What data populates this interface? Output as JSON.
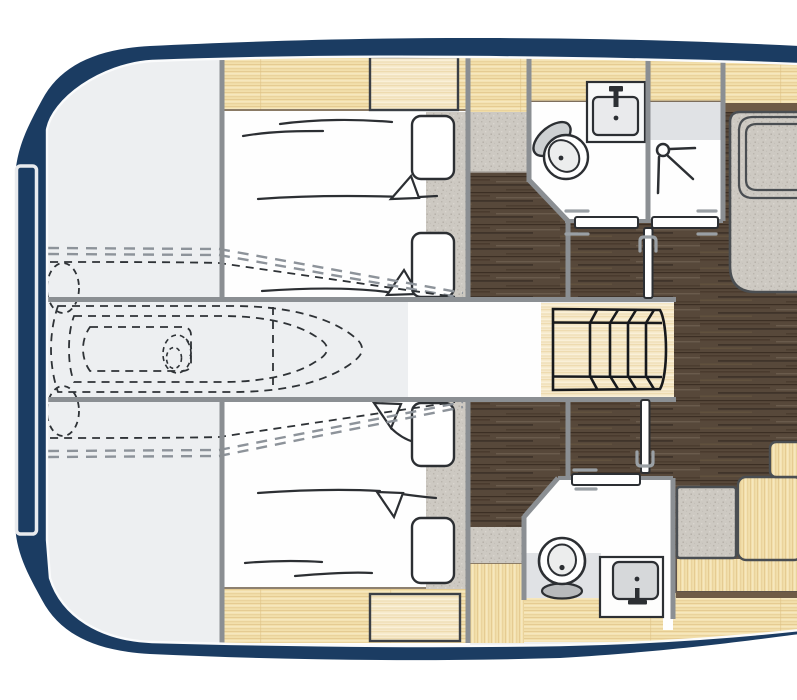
{
  "plan": {
    "type": "yacht-lower-deck-floor-plan",
    "colors": {
      "hull": "#1b3c62",
      "base_floor": "#edeff1",
      "cabin_white": "#fefefe",
      "wall": "#8b8f93",
      "wood_light": "#f2dfab",
      "wood_pale": "#f6e9cb",
      "floor_dark": "#57483a",
      "fabric_base": "#cdc9c2",
      "light_band": "#e0e2e5",
      "trim_brown": "#6f5b46",
      "fixture_line": "#2c2f33",
      "furniture_line": "#4a4e52",
      "door_fill": "#ffffff",
      "handle": "#9aa0a5",
      "dash_dark": "#2e3236",
      "dash_gray": "#8d939a",
      "hatch_stroke": "#e9ebee",
      "steps_line": "#17191c",
      "basin_fill": "#d6d8da",
      "lid_gray": "#cdd0d2",
      "toilet_base_gray": "#b8babc"
    },
    "inventory": {
      "areas": [
        "bow-storage",
        "forward-cabin-top",
        "forward-cabin-bottom",
        "corridor",
        "bathroom-top",
        "shower-room",
        "bathroom-bottom",
        "staircase-lobby"
      ],
      "fixtures": [
        "toilet-icon",
        "sink-icon",
        "shower-icon",
        "toilet-icon",
        "sink-icon"
      ],
      "furniture": [
        "double-bed",
        "double-bed",
        "wardrobe-cabinets",
        "sofa-seat",
        "seat-cushion",
        "step-boxes"
      ],
      "doors_count": 5,
      "stair_steps": 5,
      "dashed_outlines": [
        "tender-outline",
        "bow-thruster",
        "hull-chine-lines"
      ]
    }
  }
}
